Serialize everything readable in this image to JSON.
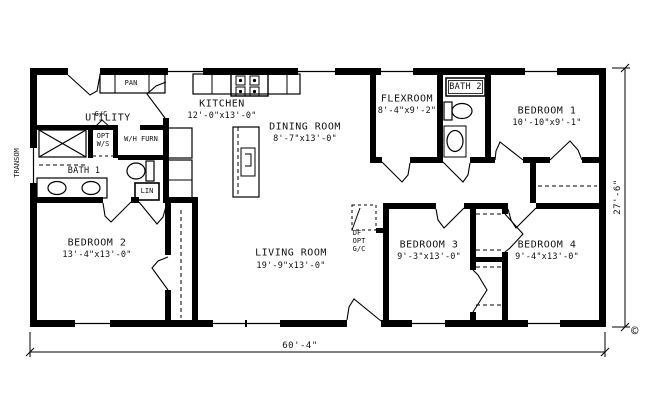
{
  "plan": {
    "rooms": [
      {
        "name": "UTILITY",
        "dims": ""
      },
      {
        "name": "KITCHEN",
        "dims": "12'-0\"x13'-0\""
      },
      {
        "name": "DINING ROOM",
        "dims": "8'-7\"x13'-0\""
      },
      {
        "name": "FLEXROOM",
        "dims": "8'-4\"x9'-2\""
      },
      {
        "name": "BATH 2",
        "dims": ""
      },
      {
        "name": "BEDROOM 1",
        "dims": "10'-10\"x9'-1\""
      },
      {
        "name": "BATH 1",
        "dims": ""
      },
      {
        "name": "BEDROOM 2",
        "dims": "13'-4\"x13'-0\""
      },
      {
        "name": "LIVING ROOM",
        "dims": "19'-9\"x13'-0\""
      },
      {
        "name": "BEDROOM 3",
        "dims": "9'-3\"x13'-0\""
      },
      {
        "name": "BEDROOM 4",
        "dims": "9'-4\"x13'-0\""
      }
    ],
    "labels": {
      "pan": "PAN",
      "gc_utility": "G/C",
      "opt_ws_line1": "OPT",
      "opt_ws_line2": "W/S",
      "wh_furn": "W/H FURN",
      "lin": "LIN",
      "df": "DF",
      "opt_gc_line1": "OPT",
      "opt_gc_line2": "G/C",
      "transom": "TRANSOM"
    },
    "dimensions": {
      "overall_width": "60'-4\"",
      "overall_height": "27'-6\""
    },
    "copyright": "©",
    "colors": {
      "line": "#000000",
      "background": "#ffffff"
    }
  }
}
